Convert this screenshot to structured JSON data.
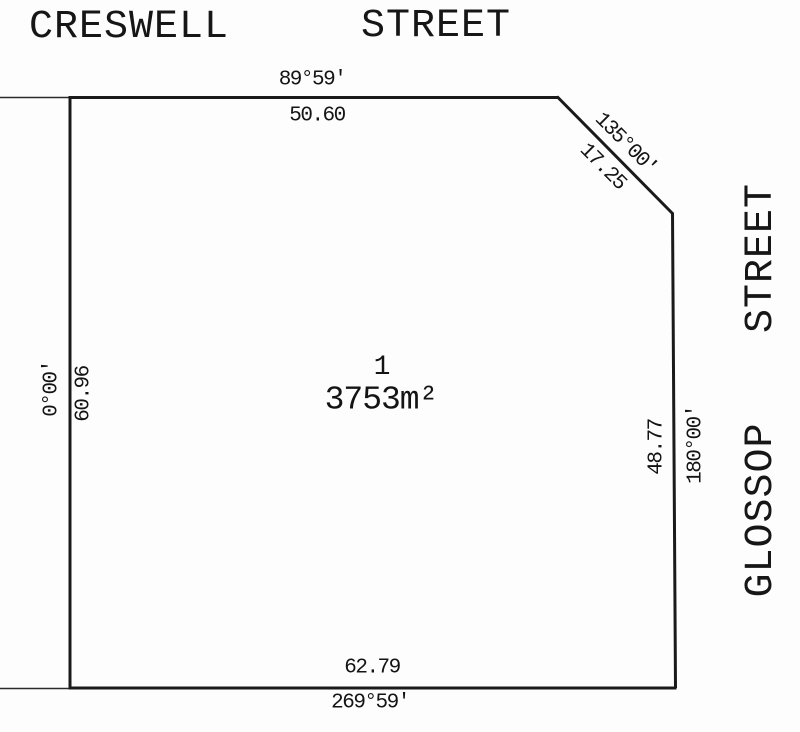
{
  "plan": {
    "type": "cadastral-survey-plan",
    "streets": {
      "top": {
        "word1": "CRESWELL",
        "word2": "STREET"
      },
      "right": {
        "word1": "GLOSSOP",
        "word2": "STREET"
      }
    },
    "lot": {
      "number": "1",
      "area": "3753m²"
    },
    "boundaries": {
      "north": {
        "bearing": "89°59'",
        "distance": "50.60"
      },
      "splay": {
        "bearing": "135°00'",
        "distance": "17.25"
      },
      "west": {
        "bearing": "0°00'",
        "distance": "60.96"
      },
      "east": {
        "bearing": "180°00'",
        "distance": "48.77"
      },
      "south": {
        "bearing": "269°59'",
        "distance": "62.79"
      }
    },
    "colors": {
      "line": "#1a1a1a",
      "background": "#fdfdfd"
    }
  }
}
